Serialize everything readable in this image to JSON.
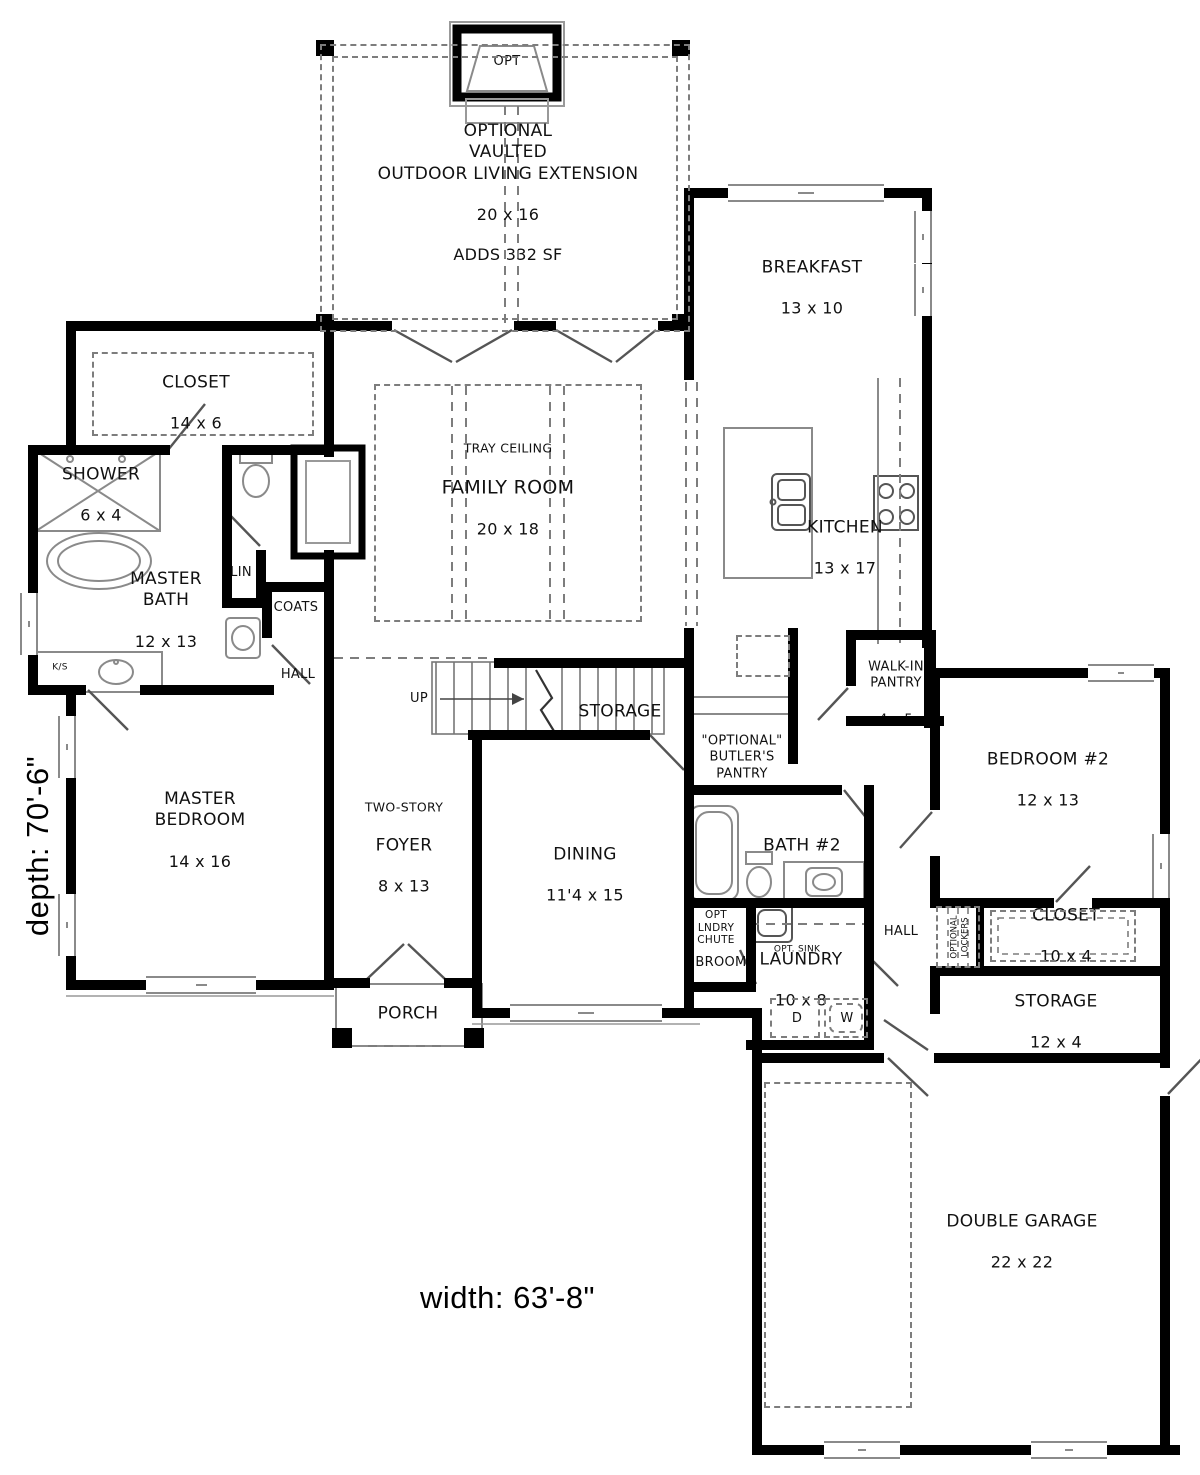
{
  "plan": {
    "width_label": "width: 63'-8\"",
    "depth_label": "depth: 70'-6\"",
    "colors": {
      "wall": "#000000",
      "thin_line": "#8a8a8a",
      "dashed": "#7d7d7d"
    }
  },
  "rooms": {
    "opt_fireplace": {
      "name": "OPT"
    },
    "outdoor_extension": {
      "name": "OPTIONAL\nVAULTED\nOUTDOOR LIVING EXTENSION",
      "dims": "20 x 16",
      "note": "ADDS 332 SF"
    },
    "breakfast": {
      "name": "BREAKFAST",
      "dims": "13 x 10"
    },
    "master_closet": {
      "name": "CLOSET",
      "dims": "14 x 6"
    },
    "shower": {
      "name": "SHOWER",
      "dims": "6 x 4"
    },
    "master_bath": {
      "name": "MASTER\nBATH",
      "dims": "12 x 13"
    },
    "linen": {
      "name": "LIN"
    },
    "coats": {
      "name": "COATS"
    },
    "hall_left": {
      "name": "HALL"
    },
    "ks": {
      "name": "K/S"
    },
    "family_room": {
      "ceiling": "TRAY CEILING",
      "name": "FAMILY ROOM",
      "dims": "20 x 18"
    },
    "kitchen": {
      "name": "KITCHEN",
      "dims": "13 x 17"
    },
    "stairs": {
      "up": "UP"
    },
    "stair_storage": {
      "name": "STORAGE"
    },
    "butlers_pantry": {
      "name": "\"OPTIONAL\"\nBUTLER'S\nPANTRY"
    },
    "walkin_pantry": {
      "name": "WALK-IN\nPANTRY",
      "dims": "4 x 5"
    },
    "bedroom2": {
      "name": "BEDROOM #2",
      "dims": "12 x 13"
    },
    "master_bedroom": {
      "name": "MASTER\nBEDROOM",
      "dims": "14 x 16"
    },
    "foyer": {
      "upper": "TWO-STORY",
      "name": "FOYER",
      "dims": "8 x 13"
    },
    "dining": {
      "name": "DINING",
      "dims": "11'4 x 15"
    },
    "bath2": {
      "name": "BATH #2"
    },
    "laundry_chute": {
      "name": "OPT\nLNDRY\nCHUTE"
    },
    "broom": {
      "name": "BROOM"
    },
    "opt_sink": {
      "name": "OPT. SINK"
    },
    "laundry": {
      "name": "LAUNDRY",
      "dims": "10 x 8"
    },
    "dryer": {
      "name": "D"
    },
    "washer": {
      "name": "W"
    },
    "hall_right": {
      "name": "HALL"
    },
    "lockers": {
      "name": "OPTIONAL\nLOCKERS"
    },
    "closet2": {
      "name": "CLOSET",
      "dims": "10 x 4"
    },
    "storage2": {
      "name": "STORAGE",
      "dims": "12 x 4"
    },
    "porch": {
      "name": "PORCH"
    },
    "garage": {
      "name": "DOUBLE GARAGE",
      "dims": "22 x 22"
    }
  }
}
